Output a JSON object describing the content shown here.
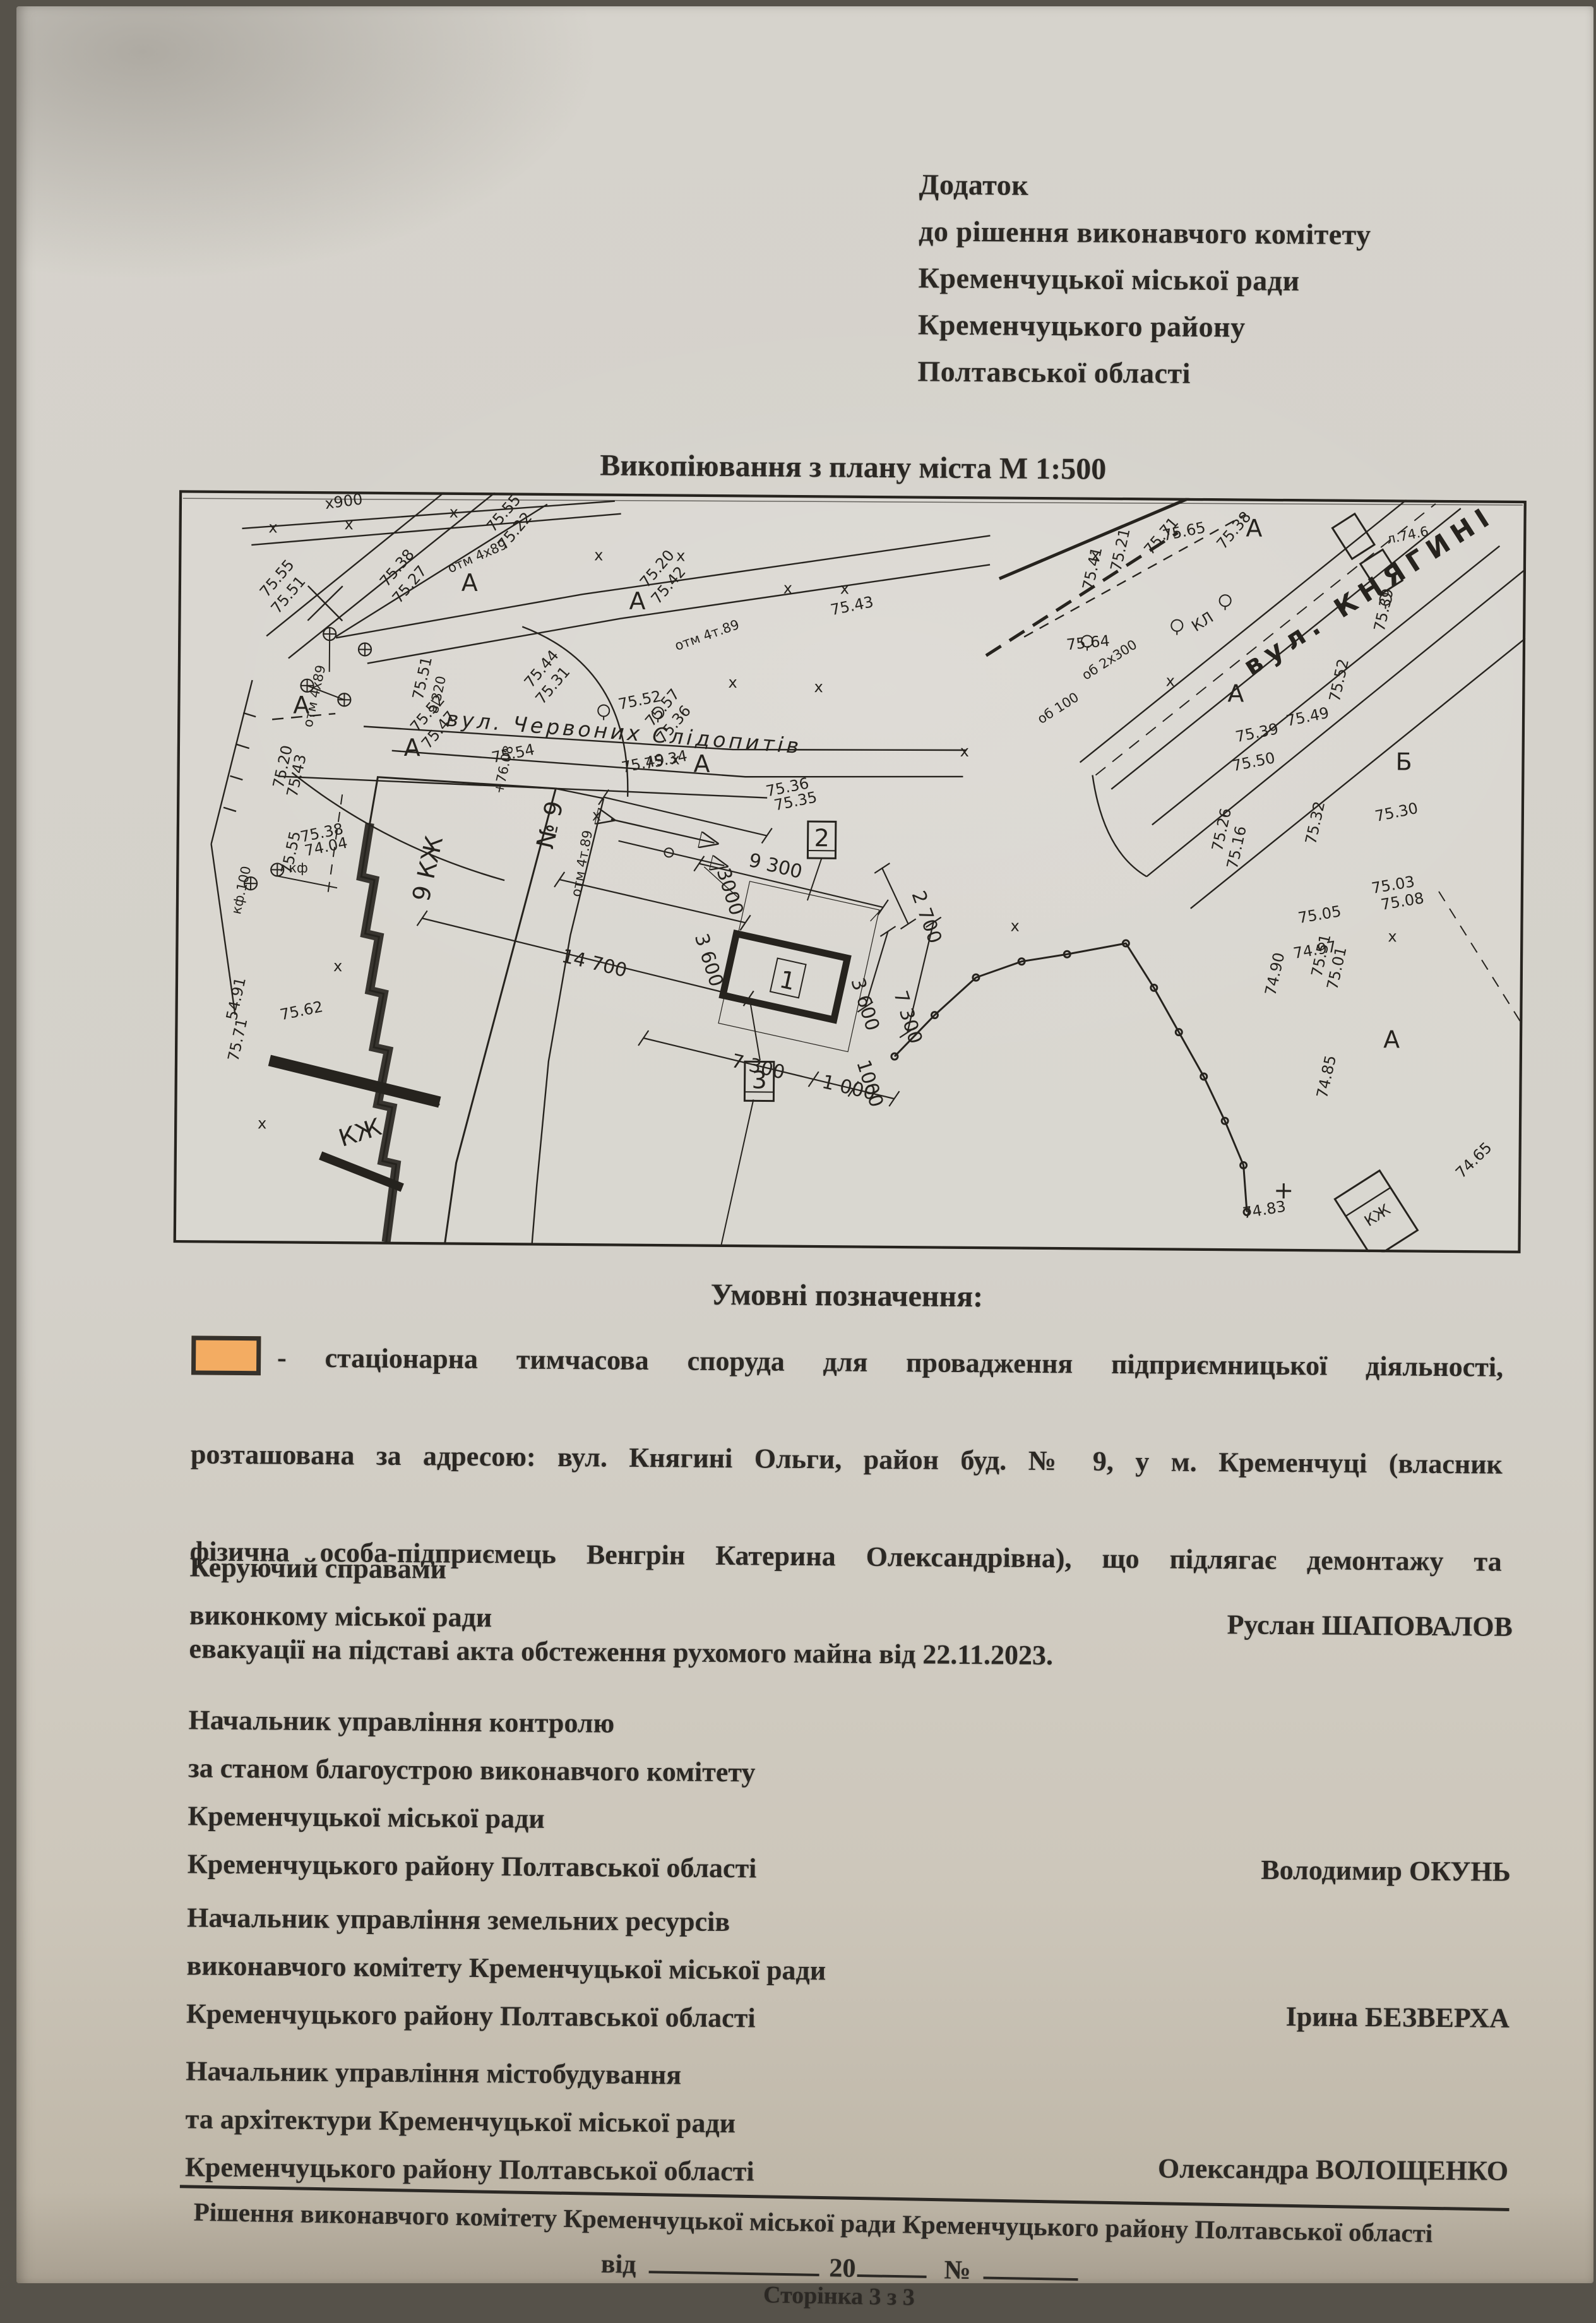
{
  "page": {
    "header_lines": [
      "Додаток",
      "до рішення виконавчого комітету",
      "Кременчуцької міської ради",
      "Кременчуцького району",
      "Полтавської області"
    ],
    "map_title": "Викопіювання з плану міста М 1:500",
    "legend_heading": "Умовні позначення:",
    "legend_lines": [
      "- стаціонарна тимчасова споруда для провадження підприємницької діяльності,",
      "розташована за адресою: вул. Княгині Ольги, район буд. № 9, у м. Кременчуці (власник",
      "фізична особа-підприємець Венгрін Катерина Олександрівна), що підлягає демонтажу та",
      "евакуації на підставі акта обстеження рухомого майна від 22.11.2023."
    ],
    "signatures": [
      {
        "title_lines": [
          "Керуючий справами",
          "виконкому міської ради"
        ],
        "name": "Руслан ШАПОВАЛОВ"
      },
      {
        "title_lines": [
          "Начальник управління контролю",
          "за станом благоустрою виконавчого комітету",
          "Кременчуцької міської ради",
          "Кременчуцького району Полтавської області"
        ],
        "name": "Володимир ОКУНЬ"
      },
      {
        "title_lines": [
          "Начальник управління земельних ресурсів",
          "виконавчого комітету Кременчуцької міської ради",
          "Кременчуцького району Полтавської області"
        ],
        "name": "Ірина БЕЗВЕРХА"
      },
      {
        "title_lines": [
          "Начальник управління містобудування",
          "та архітектури Кременчуцької міської ради",
          "Кременчуцького району Полтавської області"
        ],
        "name": "Олександра ВОЛОЩЕНКО"
      }
    ],
    "footer": {
      "line1": "Рішення виконавчого комітету Кременчуцької міської ради Кременчуцького району Полтавської області",
      "date_label": "від",
      "year_prefix": "20",
      "number_label": "№",
      "page_label": "Сторінка 3 з 3"
    },
    "colors": {
      "paper": "#d4d1ca",
      "ink": "#2b2824",
      "kiosk_orange": "#f0ab63"
    }
  },
  "map": {
    "street_chervonykh": "вул. Червоних Слідопитів",
    "street_kniahyni": "вул. КНЯГИНІ",
    "bld_9kzh": "9 КЖ",
    "bld_kzh": "КЖ",
    "house_no": "№ 9",
    "marker2": "2",
    "marker3": "3",
    "kiosk1": "1",
    "x900": "х900",
    "plus": "+",
    "dims": {
      "a": "9 300",
      "b": "2 700",
      "c": "3000",
      "d": "3 600",
      "e": "14 700",
      "f": "7 300",
      "g": "1 000",
      "h": "1000"
    },
    "letters": {
      "a": "А",
      "b": "Б",
      "x": "х",
      "kl": "КЛ"
    },
    "notes": [
      "отм 4х89",
      "отм 4т.89",
      "кф.100",
      "8/320",
      "+76.08",
      "об 2х300",
      "об 100",
      "л.74.6",
      "кф"
    ],
    "elev": [
      "75.55",
      "75.22",
      "75.38",
      "75.27",
      "75.55",
      "75.51",
      "75.20",
      "75.42",
      "75.43",
      "75.44",
      "75.31",
      "75.57",
      "75.36",
      "75.34",
      "75.51",
      "75.52",
      "75.47",
      "75.54",
      "75.49",
      "75.36",
      "75.35",
      "75.20",
      "75.43",
      "75.38",
      "74.04",
      "75.52",
      "75.55",
      "54.91",
      "75.62",
      "75.71",
      "75.65",
      "75.38",
      "75.71",
      "75.41",
      "75.21",
      "75.64",
      "75.39",
      "75.39",
      "75.50",
      "75.49",
      "75.52",
      "75.32",
      "75.30",
      "75.26",
      "75.16",
      "75.05",
      "74.97",
      "75.03",
      "75.08",
      "74.90",
      "74.85",
      "75.51",
      "75.01",
      "74.83",
      "74.65"
    ]
  }
}
